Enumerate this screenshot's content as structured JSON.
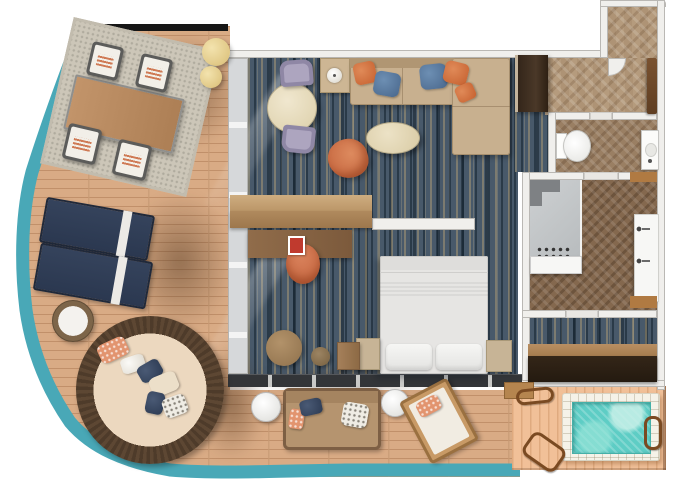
{
  "meta": {
    "type": "floor-plan",
    "subject": "cruise-ship-suite-with-wraparound-balcony",
    "canvas_width": 680,
    "canvas_height": 486
  },
  "colors": {
    "background": "#ffffff",
    "deck_wood": "#d9ab85",
    "deck_plank_line": "#c1906a",
    "deck_edge_teal": "#49a8b7",
    "balcony_top_bar": "#161616",
    "jacuzzi_deck_wood": "#f1c098",
    "carpet_base": "#48596a",
    "carpet_streak_tan": "#c9ae78",
    "hall_floor": "#b59b7d",
    "wc_floor": "#9a7f63",
    "bath_floor": "#84684e",
    "wall": "#f0efec",
    "wall_edge": "#bab8b4",
    "glass_wall": "#d6d8da",
    "door_track": "#333538",
    "wardrobe_wood": "#3f2f22",
    "entry_door_wood": "#6e4a2b",
    "console_wood": "#c3a074",
    "desk_wood": "#8a6848",
    "sofa_beige": "#c8b08f",
    "pillow_orange": "#c5602f",
    "pillow_denim": "#49678c",
    "coffee_table_cream": "#e9dfc3",
    "armchair_orange": "#ce6f48",
    "dining_table_cream": "#ece2c8",
    "side_chair_lavender": "#8f87a5",
    "bed_linen": "#e3e3e1",
    "nightstand": "#c7b496",
    "desk_chair_coral": "#d3714b",
    "magazine_red": "#c03a2e",
    "outdoor_table_wood": "#b8895f",
    "lounger_navy": "#2f3d55",
    "towel_white": "#e8e8e6",
    "pouf_yellow": "#e8d492",
    "wicker_brown": "#56412e",
    "daybed_cushion": "#ecd8bf",
    "outdoor_sofa_tan": "#b5946f",
    "deck_chair_wood": "#b5854f",
    "pool_water": "#5ecdc5",
    "pool_rim_tile": "#f5f2e8",
    "rail_brown": "#7a4a22",
    "wood_accent": "#b07a42",
    "dark_bench": "#2e2115",
    "shower_glass": "#c9ccce",
    "fixture_white": "#f7f7f5"
  },
  "rooms": [
    {
      "name": "wraparound-balcony",
      "floor": "teak-deck",
      "furniture": [
        "outdoor-rug",
        "dining-table-with-4-chairs",
        "2-round-poufs",
        "2-sun-loungers",
        "wicker-side-table",
        "round-daybed-with-pillows",
        "outdoor-sofa",
        "2-white-side-tables",
        "deck-lounge-chair"
      ]
    },
    {
      "name": "living-room",
      "floor": "blue-mottled-carpet",
      "furniture": [
        "round-table-with-2-chairs",
        "lamp-side-table",
        "l-shaped-sofa",
        "5-throw-pillows",
        "oval-coffee-table",
        "orange-armchair",
        "media-console",
        "wardrobe"
      ]
    },
    {
      "name": "bedroom",
      "floor": "blue-mottled-carpet",
      "furniture": [
        "king-bed",
        "2-nightstands",
        "desk-with-magazine",
        "desk-chair",
        "round-pouf",
        "stool",
        "cabinet"
      ]
    },
    {
      "name": "entry-hall",
      "floor": "herringbone-wood",
      "furniture": [
        "entry-door"
      ]
    },
    {
      "name": "powder-room",
      "floor": "herringbone-wood",
      "furniture": [
        "toilet",
        "sink"
      ]
    },
    {
      "name": "bathroom",
      "floor": "herringbone-wood",
      "furniture": [
        "shower",
        "shower-shelf",
        "double-vanity",
        "2-wood-benches"
      ]
    },
    {
      "name": "dressing-room",
      "floor": "blue-mottled-carpet",
      "furniture": [
        "wood-shelf",
        "dark-bench"
      ]
    },
    {
      "name": "jacuzzi-patio",
      "floor": "light-teak-deck",
      "furniture": [
        "jacuzzi-pool",
        "grab-rails",
        "wood-step"
      ]
    }
  ]
}
